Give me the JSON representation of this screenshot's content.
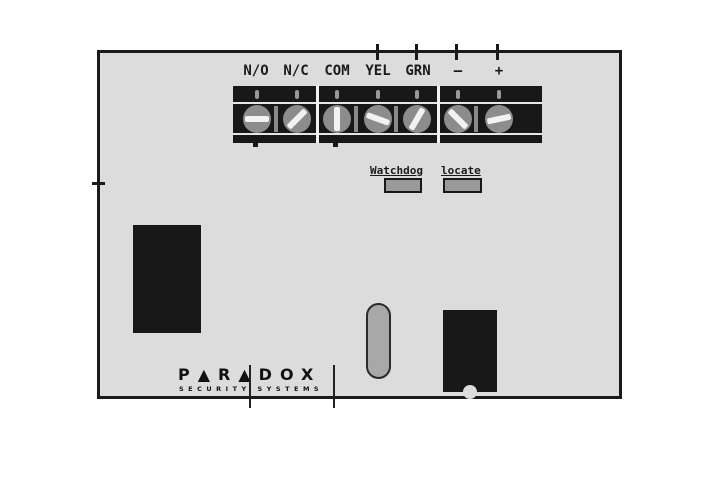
{
  "diagram": {
    "type": "security-module-pcb-diagram",
    "brand": {
      "logo_main": "P▲R▲DOX",
      "logo_sub": "SECURITY SYSTEMS"
    },
    "terminal_block": {
      "groups": [
        {
          "terminals": [
            "N/O",
            "N/C"
          ]
        },
        {
          "terminals": [
            "COM",
            "YEL",
            "GRN"
          ]
        },
        {
          "terminals": [
            "—",
            "+"
          ]
        }
      ],
      "terminals": [
        {
          "label": "N/O",
          "slot_angle": 0
        },
        {
          "label": "N/C",
          "slot_angle": -45
        },
        {
          "label": "COM",
          "slot_angle": 90
        },
        {
          "label": "YEL",
          "slot_angle": 20
        },
        {
          "label": "GRN",
          "slot_angle": -60
        },
        {
          "label": "—",
          "slot_angle": 45
        },
        {
          "label": "+",
          "slot_angle": -12
        }
      ]
    },
    "indicators": [
      {
        "label": "Watchdog"
      },
      {
        "label": "locate"
      }
    ],
    "colors": {
      "board": "#dcdcdc",
      "board_border": "#1a1a1a",
      "terminal_block": "#181818",
      "screw": "#8c8c8c",
      "screw_slot": "#f2f2f2",
      "led_fill": "#9a9a9a",
      "component": "#181818",
      "capacitor": "#a8a8a8"
    }
  }
}
